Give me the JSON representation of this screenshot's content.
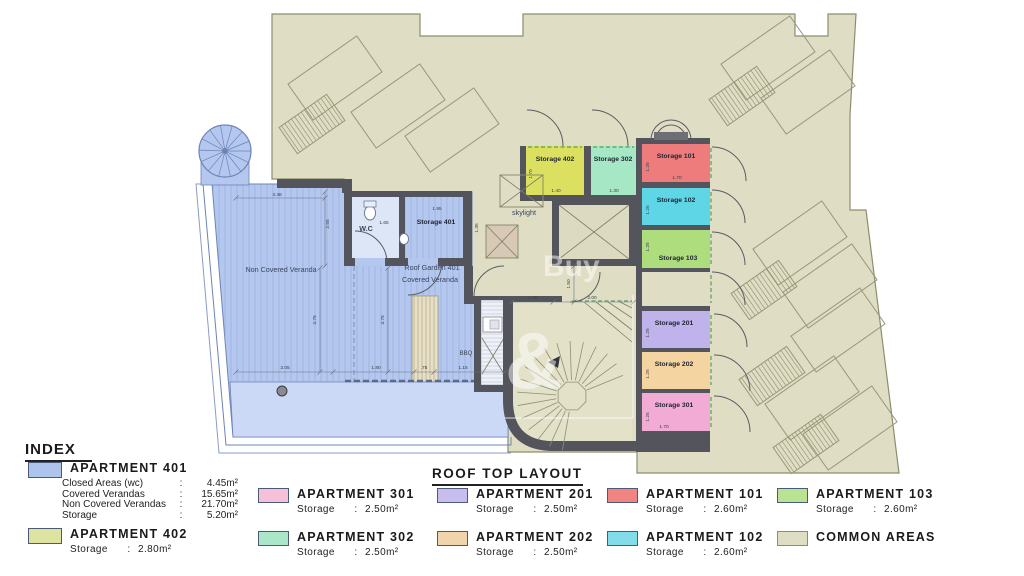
{
  "title": "ROOF TOP LAYOUT",
  "index": {
    "heading": "INDEX",
    "colon": ":",
    "a401": {
      "label": "APARTMENT 401",
      "color": "#adc4ec",
      "details": [
        {
          "name": "Closed Areas (wc)",
          "value": "4.45m²"
        },
        {
          "name": "Covered Verandas",
          "value": "15.65m²"
        },
        {
          "name": "Non Covered Verandas",
          "value": "21.70m²"
        },
        {
          "name": "Storage",
          "value": "5.20m²"
        }
      ]
    },
    "a402": {
      "label": "APARTMENT 402",
      "color": "#dfe3a2",
      "storage_name": "Storage",
      "storage_value": "2.80m²"
    }
  },
  "legend": {
    "storage_word": "Storage",
    "colon": ":",
    "items_row1": [
      {
        "label": "APARTMENT 301",
        "color": "#f5c0d8",
        "storage": "2.50m²"
      },
      {
        "label": "APARTMENT 201",
        "color": "#c9bdee",
        "storage": "2.50m²"
      },
      {
        "label": "APARTMENT 101",
        "color": "#f28383",
        "storage": "2.60m²"
      },
      {
        "label": "APARTMENT 103",
        "color": "#b9e293",
        "storage": "2.60m²"
      }
    ],
    "items_row2": [
      {
        "label": "APARTMENT 302",
        "color": "#a9e7c8",
        "storage": "2.50m²"
      },
      {
        "label": "APARTMENT 202",
        "color": "#f0d4ab",
        "storage": "2.50m²"
      },
      {
        "label": "APARTMENT 102",
        "color": "#82dcea",
        "storage": "2.60m²"
      },
      {
        "label": "COMMON AREAS",
        "color": "#dfdec4"
      }
    ]
  },
  "plan": {
    "colors": {
      "common": "#dfdec4",
      "common_stroke": "#8d8d6e",
      "wall": "#54545c",
      "veranda": "#b4c7ee",
      "veranda_light": "#ccd9f6",
      "wc_floor": "#dce6f6",
      "planter": "#e7dfc6"
    },
    "rooms": {
      "s402": {
        "label": "Storage 402",
        "color": "#dce060",
        "dim_side": "1.70",
        "dim_bottom": "1.40"
      },
      "s302": {
        "label": "Storage 302",
        "color": "#a6e7c6",
        "dim_bottom": "1.30"
      },
      "s101": {
        "label": "Storage 101",
        "color": "#ee7c7c",
        "dim_side": "1.25",
        "dim_bottom": "1.70"
      },
      "s102": {
        "label": "Storage 102",
        "color": "#5fd6e6",
        "dim_side": "1.25"
      },
      "s103": {
        "label": "Storage 103",
        "color": "#aedd7e",
        "dim_side": "1.25"
      },
      "s201": {
        "label": "Storage 201",
        "color": "#c0b2ea",
        "dim_side": "1.25"
      },
      "s202": {
        "label": "Storage 202",
        "color": "#f4d4a0",
        "dim_side": "1.25"
      },
      "s301": {
        "label": "Storage 301",
        "color": "#f2abd4",
        "dim_side": "1.25",
        "dim_bottom": "1.70"
      }
    },
    "labels": {
      "non_covered": "Non Covered Veranda",
      "roof_garden": "Roof Garden 401",
      "covered_veranda": "Covered Veranda",
      "wc": "W.C",
      "storage401": "Storage 401",
      "skylight": "skylight",
      "bbq": "BBQ"
    },
    "dims": {
      "top": "3.48",
      "left_v": "2.55",
      "v1": "3.75",
      "v2": "3.75",
      "b1": "3.05",
      "b2": "1.80",
      "b3": ".75",
      "b4": "1.15",
      "wc": "1.65",
      "s401_top": "1.95",
      "s401_side": "1.35",
      "c1": "1.00",
      "c2": "2.00",
      "c_v": "1.50"
    },
    "watermark": {
      "word": "Buy",
      "amp": "&"
    }
  }
}
